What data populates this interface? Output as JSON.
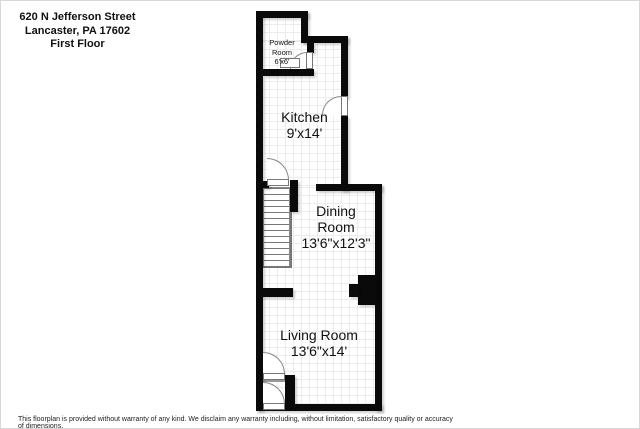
{
  "header": {
    "line1": "620 N Jefferson Street",
    "line2": "Lancaster, PA 17602",
    "line3": "First Floor"
  },
  "rooms": {
    "powder": {
      "name_line1": "Powder",
      "name_line2": "Room",
      "dims": "6'x6'"
    },
    "kitchen": {
      "name": "Kitchen",
      "dims": "9'x14'"
    },
    "dining": {
      "name_line1": "Dining",
      "name_line2": "Room",
      "dims": "13'6\"x12'3\""
    },
    "living": {
      "name": "Living Room",
      "dims": "13'6\"x14'"
    }
  },
  "footer": {
    "disclaimer": "This floorplan is provided without warranty of any kind. We disclaim any warranty including, without limitation, satisfactory quality or accuracy of dimensions."
  },
  "colors": {
    "wall": "#0a0a0a",
    "floor_grid": "#ececec",
    "floor": "#ffffff"
  }
}
